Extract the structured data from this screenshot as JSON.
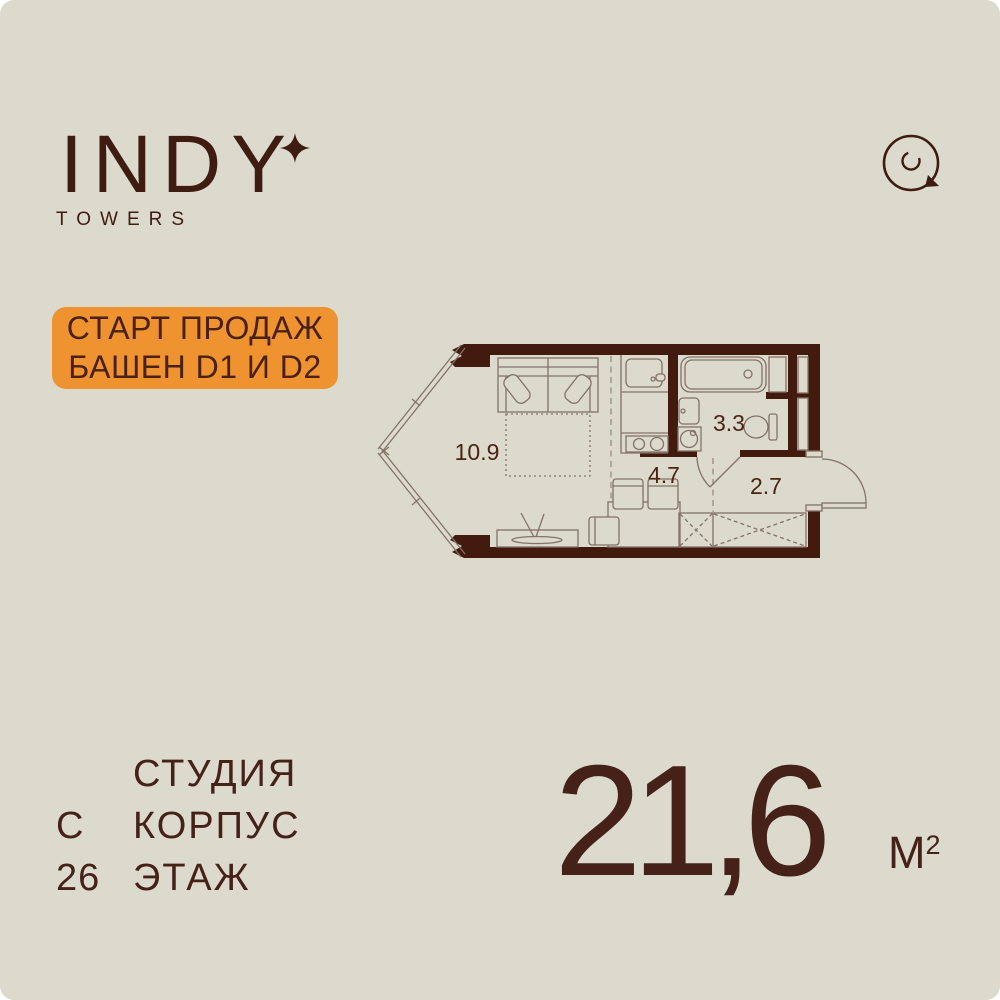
{
  "brand": {
    "name": "INDY",
    "tagline": "TOWERS",
    "sparkle_icon": "four-point-star",
    "compass_icon": "compass-circle"
  },
  "badge": {
    "line1": "СТАРТ ПРОДАЖ",
    "line2": "БАШЕН D1 И D2"
  },
  "floorplan": {
    "type": "studio-apartment-plan",
    "rooms": [
      {
        "name": "living-room",
        "area": "10.9"
      },
      {
        "name": "kitchen",
        "area": "4.7"
      },
      {
        "name": "bathroom",
        "area": "3.3"
      },
      {
        "name": "hallway",
        "area": "2.7"
      }
    ]
  },
  "details": {
    "rows": [
      {
        "label": "СТУДИЯ",
        "value": ""
      },
      {
        "label": "КОРПУС",
        "value": "С"
      },
      {
        "label": "ЭТАЖ",
        "value": "26"
      }
    ]
  },
  "area": {
    "value": "21,6",
    "unit": "М",
    "unit_exponent": "2"
  },
  "colors": {
    "background": "#dcdacd",
    "ink": "#45211a",
    "wall": "#421b0e",
    "thin_line": "#847266",
    "accent_orange": "#ef9330",
    "badge_text": "#4a2114"
  }
}
